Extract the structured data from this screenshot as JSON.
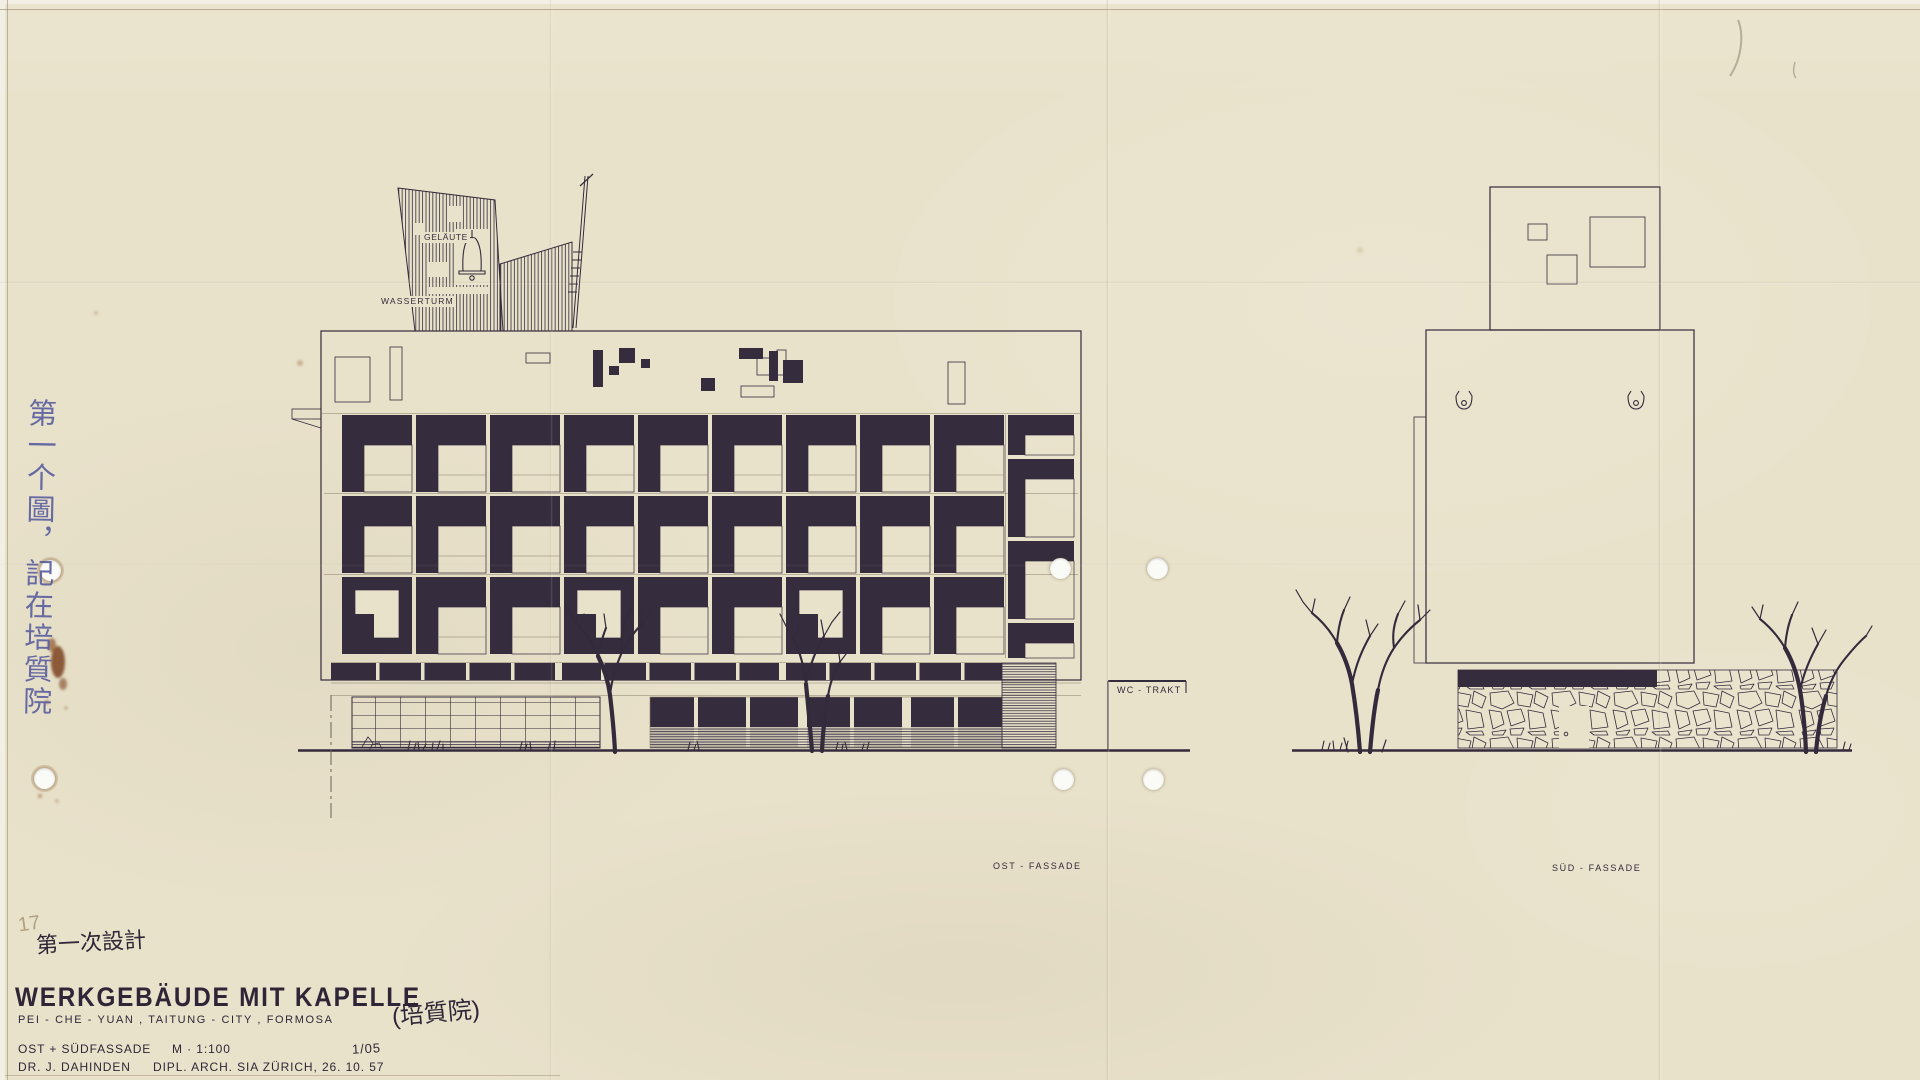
{
  "colors": {
    "paper": "#e9e2cb",
    "ink": "#332a3b",
    "ink_fill": "#352c3d",
    "hairline": "#8a7f6b",
    "blue_ink": "#585c9e",
    "pencil": "#a3906f",
    "rust": "#7b431c"
  },
  "sheet": {
    "page_number_pencil": "17"
  },
  "side_note": {
    "text_zh": "第一个圖，記在培質院"
  },
  "labels": {
    "gelaeute": "GELÄUTE",
    "wasserturm": "WASSERTURM",
    "wc_trakt": "WC - TRAKT",
    "ost_fassade": "OST - FASSADE",
    "sued_fassade": "SÜD - FASSADE"
  },
  "title_block": {
    "design_note_zh": "第一次設計",
    "title": "WERKGEBÄUDE MIT KAPELLE",
    "subtitle": "PEI - CHE - YUAN , TAITUNG - CITY , FORMOSA",
    "subtitle_zh": "(培質院)",
    "content_line": "OST + SÜDFASSADE",
    "scale": "M · 1:100",
    "sheet_no": "1/05",
    "architect": "DR. J. DAHINDEN",
    "credentials": "DIPL. ARCH. SIA ZÜRICH, 26. 10. 57"
  },
  "drawing": {
    "east_facade": {
      "grid": {
        "x": 342,
        "y": 415,
        "cols": 9,
        "rows": 3,
        "pitch_x": 74,
        "pitch_y": 81,
        "cell_w": 70,
        "cell_h": 77,
        "bar_w": 22,
        "bar_h": 30,
        "ring_cols_last_row": [
          0,
          3,
          6
        ]
      },
      "right_bay": {
        "x": 1008,
        "w": 66,
        "cells": [
          [
            415,
            40
          ],
          [
            459,
            78
          ],
          [
            541,
            78
          ],
          [
            623,
            35
          ]
        ]
      },
      "attic_shapes": {
        "outlined": [
          [
            335,
            357,
            35,
            45
          ],
          [
            390,
            347,
            12,
            53
          ],
          [
            526,
            353,
            24,
            10
          ],
          [
            757,
            358,
            17,
            17
          ],
          [
            777,
            350,
            9,
            25
          ],
          [
            741,
            386,
            33,
            11
          ],
          [
            948,
            362,
            17,
            42
          ]
        ],
        "filled": [
          [
            593,
            350,
            10,
            37
          ],
          [
            619,
            348,
            16,
            15
          ],
          [
            609,
            366,
            10,
            9
          ],
          [
            641,
            359,
            9,
            9
          ],
          [
            701,
            378,
            14,
            13
          ],
          [
            739,
            348,
            24,
            11
          ],
          [
            769,
            351,
            9,
            30
          ],
          [
            783,
            360,
            20,
            23
          ]
        ]
      },
      "clerestory": {
        "x": 331,
        "y": 663,
        "w": 671,
        "h": 17,
        "tick_every": 45
      }
    }
  }
}
